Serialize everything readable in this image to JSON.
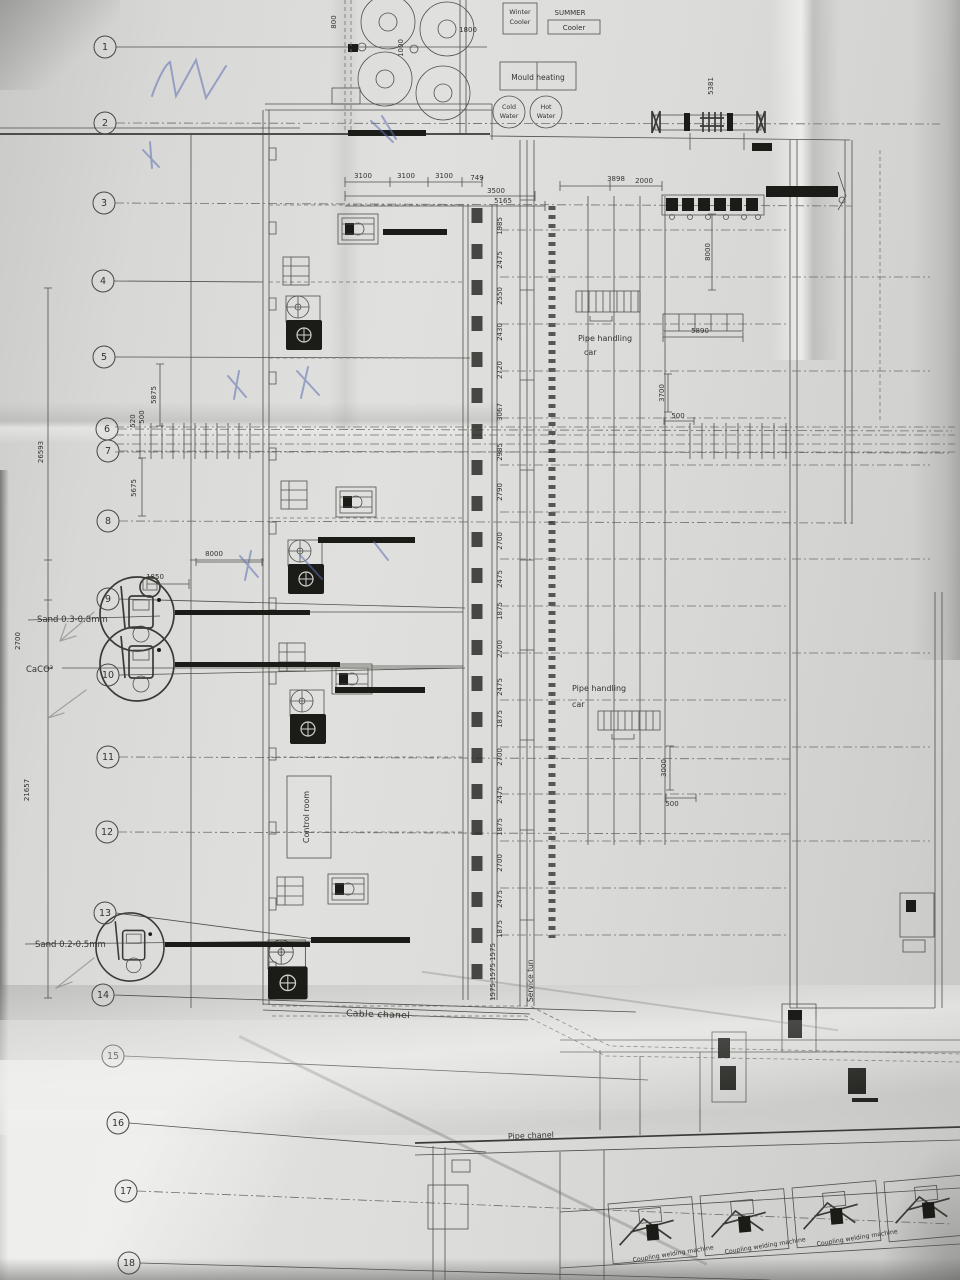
{
  "equipment_labels": {
    "winter_cooler_line1": "Winter",
    "winter_cooler_line2": "Cooler",
    "summer_cooler_line1": "SUMMER",
    "summer_cooler_line2": "Cooler",
    "mould_heating": "Mould heating",
    "cold_water_line1": "Cold",
    "cold_water_line2": "Water",
    "hot_water_line1": "Hot",
    "hot_water_line2": "Water",
    "pipe_handling_car_line1": "Pipe handling",
    "pipe_handling_car_line2": "car",
    "control_room": "Control room",
    "cable_channel": "Cable chanel",
    "service_tunnel": "Service tun",
    "pipe_channel": "Pipe chanel",
    "coupling_welding_machine": "Coupling welding machine"
  },
  "material_labels": {
    "sand_coarse": "Sand 0.3-0.8mm",
    "caco3": "CaCO³",
    "sand_fine": "Sand 0.2-0.5mm"
  },
  "grid_bubbles": [
    {
      "n": "1",
      "x": 105,
      "y": 47,
      "ex": 487,
      "ey": 47
    },
    {
      "n": "2",
      "x": 105,
      "y": 123,
      "ex": 940,
      "ey": 124,
      "dd": true
    },
    {
      "n": "3",
      "x": 104,
      "y": 203,
      "ex": 852,
      "ey": 206,
      "dd": true
    },
    {
      "n": "4",
      "x": 103,
      "y": 281,
      "ex": 263,
      "ey": 282
    },
    {
      "n": "5",
      "x": 104,
      "y": 357,
      "ex": 470,
      "ey": 358
    },
    {
      "n": "6",
      "x": 107,
      "y": 429,
      "ex": 952,
      "ey": 431,
      "dd": true
    },
    {
      "n": "7",
      "x": 108,
      "y": 451,
      "ex": 952,
      "ey": 453,
      "dd": true
    },
    {
      "n": "8",
      "x": 108,
      "y": 521,
      "ex": 852,
      "ey": 523,
      "dd": true
    },
    {
      "n": "9",
      "x": 108,
      "y": 599,
      "ex": 465,
      "ey": 608
    },
    {
      "n": "10",
      "x": 108,
      "y": 675,
      "ex": 465,
      "ey": 668
    },
    {
      "n": "11",
      "x": 108,
      "y": 757,
      "ex": 790,
      "ey": 759,
      "dd": true
    },
    {
      "n": "12",
      "x": 107,
      "y": 832,
      "ex": 790,
      "ey": 834,
      "dd": true
    },
    {
      "n": "13",
      "x": 105,
      "y": 913,
      "ex": 330,
      "ey": 941
    },
    {
      "n": "14",
      "x": 103,
      "y": 995,
      "ex": 636,
      "ey": 1012
    },
    {
      "n": "15",
      "x": 113,
      "y": 1056,
      "ex": 648,
      "ey": 1080
    },
    {
      "n": "16",
      "x": 118,
      "y": 1123,
      "ex": 486,
      "ey": 1152
    },
    {
      "n": "17",
      "x": 126,
      "y": 1191,
      "ex": 952,
      "ey": 1224,
      "dd": true
    },
    {
      "n": "18",
      "x": 129,
      "y": 1263,
      "ex": 770,
      "ey": 1280
    }
  ],
  "dimensions": [
    {
      "t": "800",
      "x": 336,
      "y": 22,
      "r": -90
    },
    {
      "t": "1000",
      "x": 403,
      "y": 48,
      "r": -90
    },
    {
      "t": "1800",
      "x": 468,
      "y": 32
    },
    {
      "t": "5381",
      "x": 713,
      "y": 86,
      "r": -90
    },
    {
      "t": "3100",
      "x": 363,
      "y": 178
    },
    {
      "t": "3100",
      "x": 406,
      "y": 178
    },
    {
      "t": "3100",
      "x": 444,
      "y": 178
    },
    {
      "t": "749",
      "x": 477,
      "y": 180
    },
    {
      "t": "3500",
      "x": 496,
      "y": 193
    },
    {
      "t": "5165",
      "x": 503,
      "y": 203
    },
    {
      "t": "3898",
      "x": 616,
      "y": 181
    },
    {
      "t": "2000",
      "x": 644,
      "y": 183
    },
    {
      "t": "8000",
      "x": 710,
      "y": 252,
      "r": -90
    },
    {
      "t": "5890",
      "x": 700,
      "y": 333
    },
    {
      "t": "3700",
      "x": 664,
      "y": 393,
      "r": -90
    },
    {
      "t": "500",
      "x": 678,
      "y": 418
    },
    {
      "t": "5875",
      "x": 156,
      "y": 395,
      "r": -90
    },
    {
      "t": "500",
      "x": 144,
      "y": 417,
      "r": -90
    },
    {
      "t": "520",
      "x": 135,
      "y": 421,
      "r": -90
    },
    {
      "t": "5675",
      "x": 136,
      "y": 488,
      "r": -90
    },
    {
      "t": "26593",
      "x": 43,
      "y": 452,
      "r": -90
    },
    {
      "t": "8000",
      "x": 214,
      "y": 556
    },
    {
      "t": "1850",
      "x": 155,
      "y": 579
    },
    {
      "t": "2700",
      "x": 20,
      "y": 641,
      "r": -90
    },
    {
      "t": "3000",
      "x": 666,
      "y": 768,
      "r": -90
    },
    {
      "t": "500",
      "x": 672,
      "y": 806
    },
    {
      "t": "21657",
      "x": 29,
      "y": 790,
      "r": -90
    },
    {
      "t": "1985",
      "x": 502,
      "y": 226,
      "r": -90
    },
    {
      "t": "2475",
      "x": 502,
      "y": 260,
      "r": -90
    },
    {
      "t": "2550",
      "x": 502,
      "y": 296,
      "r": -90
    },
    {
      "t": "2430",
      "x": 502,
      "y": 332,
      "r": -90
    },
    {
      "t": "2720",
      "x": 502,
      "y": 370,
      "r": -90
    },
    {
      "t": "3067",
      "x": 502,
      "y": 412,
      "r": -90
    },
    {
      "t": "2985",
      "x": 502,
      "y": 452,
      "r": -90
    },
    {
      "t": "2790",
      "x": 502,
      "y": 492,
      "r": -90
    },
    {
      "t": "2700",
      "x": 502,
      "y": 541,
      "r": -90
    },
    {
      "t": "2475",
      "x": 502,
      "y": 579,
      "r": -90
    },
    {
      "t": "1875",
      "x": 502,
      "y": 611,
      "r": -90
    },
    {
      "t": "2700",
      "x": 502,
      "y": 649,
      "r": -90
    },
    {
      "t": "2475",
      "x": 502,
      "y": 687,
      "r": -90
    },
    {
      "t": "1875",
      "x": 502,
      "y": 719,
      "r": -90
    },
    {
      "t": "2700",
      "x": 502,
      "y": 757,
      "r": -90
    },
    {
      "t": "2475",
      "x": 502,
      "y": 795,
      "r": -90
    },
    {
      "t": "1875",
      "x": 502,
      "y": 827,
      "r": -90
    },
    {
      "t": "2700",
      "x": 502,
      "y": 863,
      "r": -90
    },
    {
      "t": "2475",
      "x": 502,
      "y": 899,
      "r": -90
    },
    {
      "t": "1875",
      "x": 502,
      "y": 929,
      "r": -90
    },
    {
      "t": "1575",
      "x": 495,
      "y": 952,
      "r": -90
    },
    {
      "t": "1575",
      "x": 495,
      "y": 972,
      "r": -90
    },
    {
      "t": "1575",
      "x": 495,
      "y": 992,
      "r": -90
    }
  ]
}
